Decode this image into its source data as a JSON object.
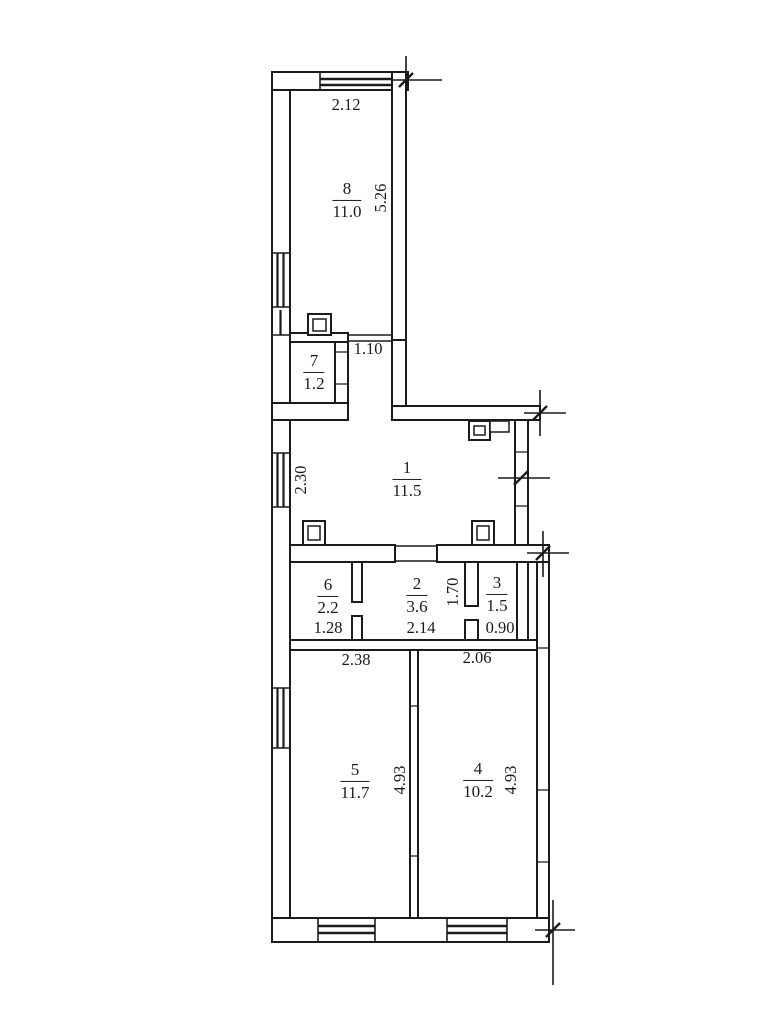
{
  "drawing": {
    "kind": "apartment floor plan",
    "colors": {
      "ink": "#1b1b1b",
      "paper": "#ffffff"
    }
  },
  "rooms": [
    {
      "number": "8",
      "area": "11.0"
    },
    {
      "number": "7",
      "area": "1.2"
    },
    {
      "number": "1",
      "area": "11.5"
    },
    {
      "number": "6",
      "area": "2.2"
    },
    {
      "number": "2",
      "area": "3.6"
    },
    {
      "number": "3",
      "area": "1.5"
    },
    {
      "number": "5",
      "area": "11.7"
    },
    {
      "number": "4",
      "area": "10.2"
    }
  ],
  "dimensions": {
    "room8_width": "2.12",
    "room8_depth": "5.26",
    "corridor_width": "1.10",
    "room1_left_height": "2.30",
    "room6_width": "1.28",
    "room2_width": "2.14",
    "room2_depth": "1.70",
    "room3_width": "0.90",
    "room5_width": "2.38",
    "room4_width": "2.06",
    "room5_depth": "4.93",
    "room4_depth": "4.93"
  }
}
